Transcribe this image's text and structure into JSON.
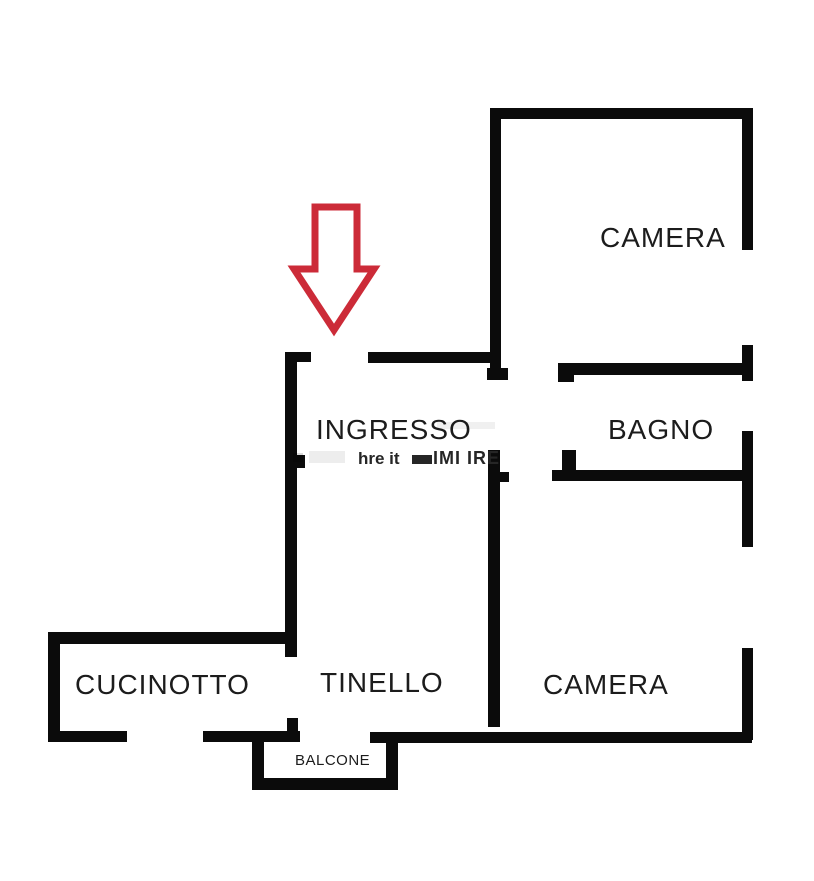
{
  "rooms": [
    {
      "id": "camera-top",
      "label": "CAMERA"
    },
    {
      "id": "bagno",
      "label": "BAGNO"
    },
    {
      "id": "ingresso",
      "label": "INGRESSO"
    },
    {
      "id": "cucinotto",
      "label": "CUCINOTTO"
    },
    {
      "id": "tinello",
      "label": "TINELLO"
    },
    {
      "id": "camera-bottom",
      "label": "CAMERA"
    },
    {
      "id": "balcone",
      "label": "BALCONE"
    }
  ],
  "watermark": {
    "segment_1": "hre it",
    "segment_2": "IMI IRE"
  },
  "icons": {
    "entrance_arrow": "down-arrow-outline"
  },
  "colors": {
    "wall": "#0b0b0b",
    "background": "#ffffff",
    "label_text": "#1c1c1c",
    "arrow_red": "#cc2b38",
    "watermark_dark": "#262626"
  }
}
